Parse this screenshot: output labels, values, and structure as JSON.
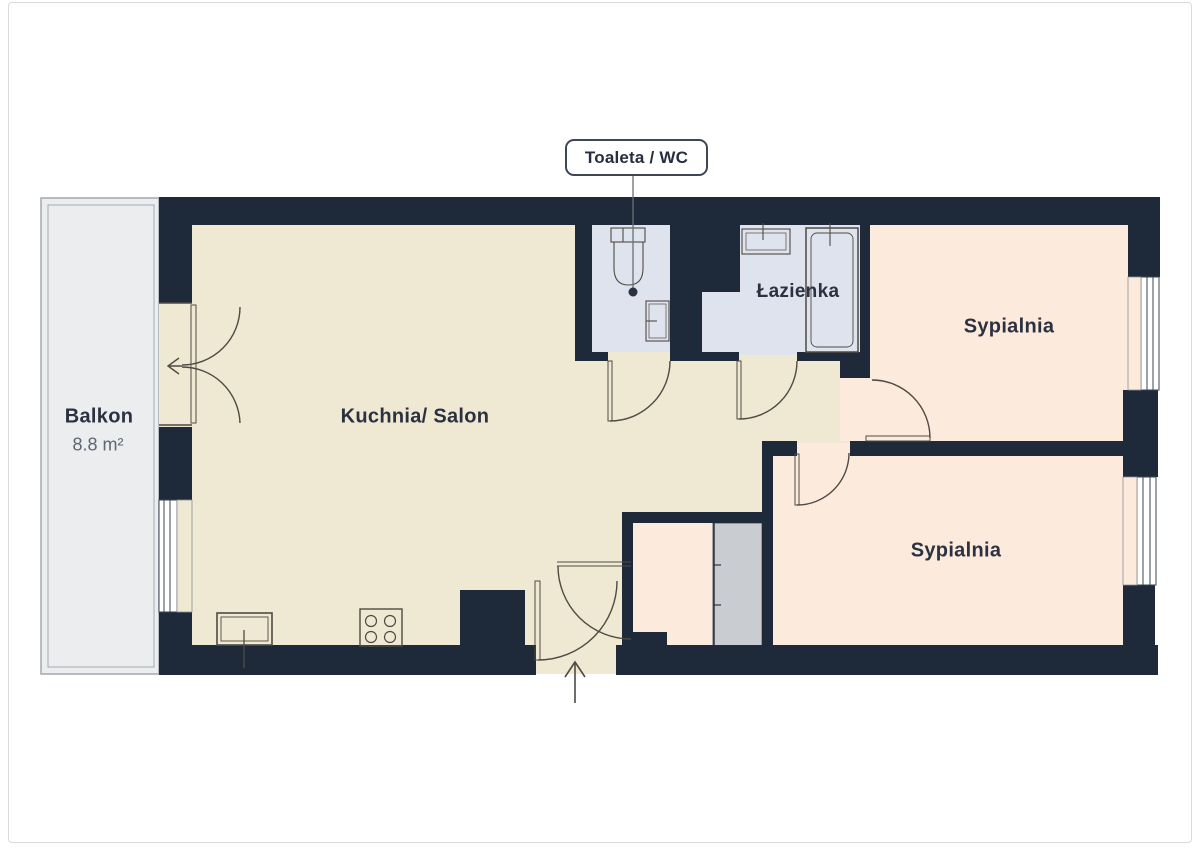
{
  "callout": {
    "label": "Toaleta / WC"
  },
  "rooms": {
    "balcony": {
      "name": "Balkon",
      "area": "8.8 m²"
    },
    "kitchen_living": {
      "name": "Kuchnia/ Salon"
    },
    "bathroom": {
      "name": "Łazienka"
    },
    "bedroom_top": {
      "name": "Sypialnia"
    },
    "bedroom_bottom": {
      "name": "Sypialnia"
    }
  },
  "fixtures": {
    "toilet": "toilet",
    "wc_sink": "washbasin",
    "bath_sink": "washbasin",
    "bathtub": "bathtub",
    "kitchen_sink": "kitchen-sink",
    "stove": "stove-4-burners",
    "wardrobe": "sliding-wardrobe"
  },
  "colors": {
    "wall": "#1e2a3a",
    "living_floor": "#efe8d2",
    "bedroom_floor": "#fcebdd",
    "bath_floor": "#dfe3ed",
    "balcony_floor": "#ecedee",
    "wardrobe": "#c9cdd2",
    "stroke": "#4f4b44",
    "text": "#2b3140"
  }
}
